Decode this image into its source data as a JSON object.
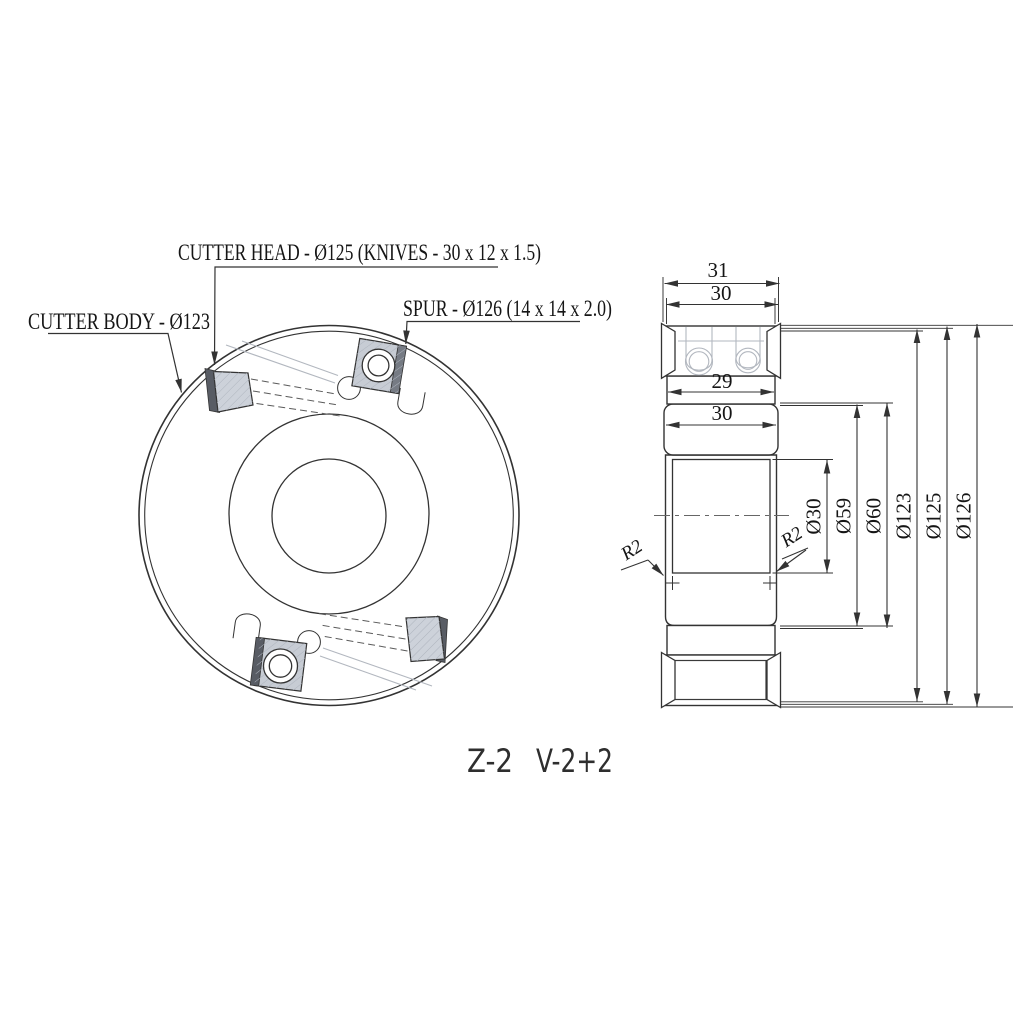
{
  "labels": {
    "cutter_head": "CUTTER HEAD - Ø125 (KNIVES - 30 x 12 x 1.5)",
    "spur": "SPUR - Ø126 (14 x 14 x 2.0)",
    "cutter_body": "CUTTER BODY - Ø123"
  },
  "marking": {
    "teeth": "Z-2",
    "wings": "V-2+2"
  },
  "dims": {
    "overall_width": "31",
    "head_width": "30",
    "body_width": "29",
    "hub_width": "30",
    "bore": "Ø30",
    "hub_d59": "Ø59",
    "hub_d60": "Ø60",
    "body_dia": "Ø123",
    "head_dia": "Ø125",
    "spur_dia": "Ø126",
    "fillet_left": "R2",
    "fillet_right": "R2"
  },
  "colors": {
    "line": "#333333",
    "faint_line": "#b2b7bf",
    "knife_fill": "#cdd2da",
    "spur_fill": "#c7ccd4",
    "edge_dark": "#585c64",
    "background": "#ffffff",
    "text": "#151515"
  }
}
